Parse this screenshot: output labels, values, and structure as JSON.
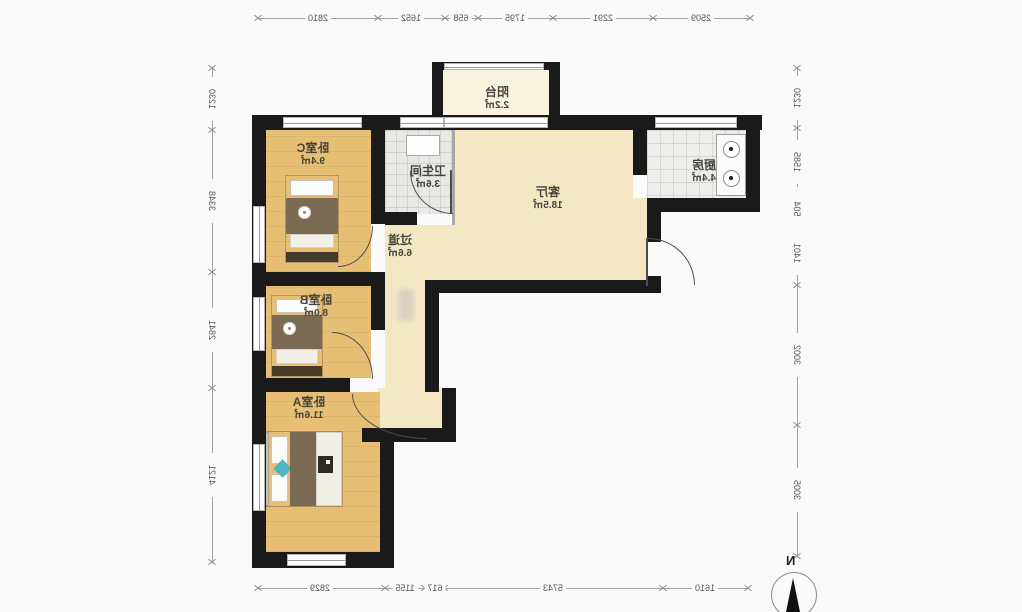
{
  "rooms": {
    "balcony": {
      "name": "阳台",
      "area": "2.2㎡"
    },
    "bedroomC": {
      "name": "卧室C",
      "area": "9.4㎡"
    },
    "bathroom": {
      "name": "卫生间",
      "area": "3.6㎡"
    },
    "living": {
      "name": "客厅",
      "area": "18.5㎡"
    },
    "kitchen": {
      "name": "厨房",
      "area": "4.4㎡"
    },
    "hallway": {
      "name": "过道",
      "area": "6.6㎡"
    },
    "bedroomB": {
      "name": "卧室B",
      "area": "8.0㎡"
    },
    "bedroomA": {
      "name": "卧室A",
      "area": "11.6㎡"
    }
  },
  "dimensions": {
    "top": [
      "2810",
      "1652",
      "658",
      "1795",
      "2291",
      "2509"
    ],
    "bottom": [
      "2829",
      "1155",
      "617",
      "5743",
      "1610"
    ],
    "left": [
      "1230",
      "3348",
      "2841",
      "4121"
    ],
    "right": [
      "1230",
      "1585",
      "504",
      "1401",
      "3002",
      "3005"
    ]
  },
  "compass": {
    "label": "N"
  },
  "colors": {
    "wall": "#1a1a1a",
    "wood_floor": "#e6be74",
    "living_floor": "#f4e8c4",
    "tile_floor": "#e8e8e5",
    "balcony_floor": "#f8f3df",
    "bed_blanket": "#7a6a54",
    "accent_teal": "#4db6c4"
  }
}
